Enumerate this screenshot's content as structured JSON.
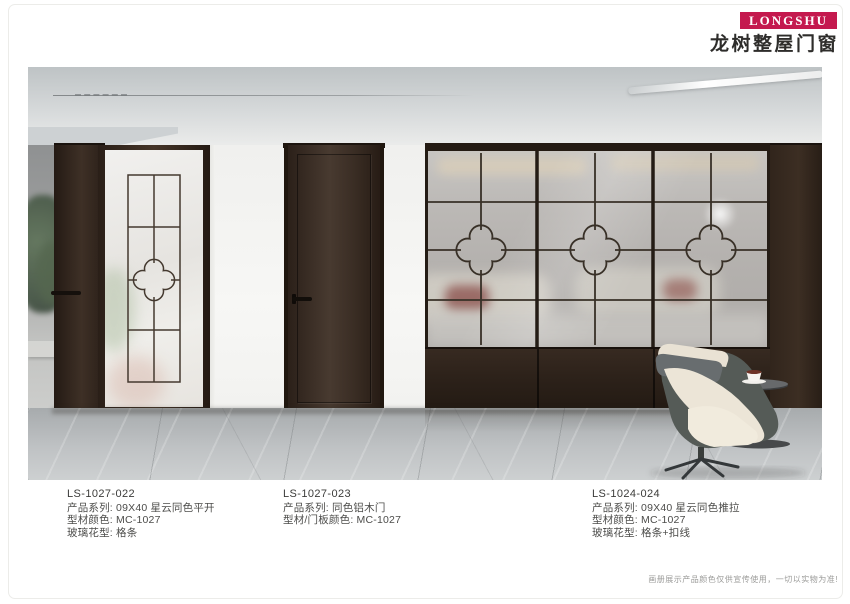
{
  "brand": {
    "logo_text": "LONGSHU",
    "logo_color": "#c4194e",
    "name_cn": "龙树整屋门窗"
  },
  "products": [
    {
      "code": "LS-1027-022",
      "lines": [
        "产品系列: 09X40 星云同色平开",
        "型材颜色: MC-1027",
        "玻璃花型: 格条"
      ]
    },
    {
      "code": "LS-1027-023",
      "lines": [
        "产品系列: 同色铝木门",
        "型材/门板颜色: MC-1027"
      ]
    },
    {
      "code": "LS-1024-024",
      "lines": [
        "产品系列: 09X40 星云同色推拉",
        "型材颜色: MC-1027",
        "玻璃花型: 格条+扣线"
      ]
    }
  ],
  "footer": {
    "disclaimer": "画册展示产品颜色仅供宣传使用，一切以实物为准!"
  },
  "scene": {
    "colors": {
      "wood": "#3a2c22",
      "grid_line": "#3f362e",
      "wall": "#f5f5f3",
      "floor": "#b7bbbd"
    }
  }
}
